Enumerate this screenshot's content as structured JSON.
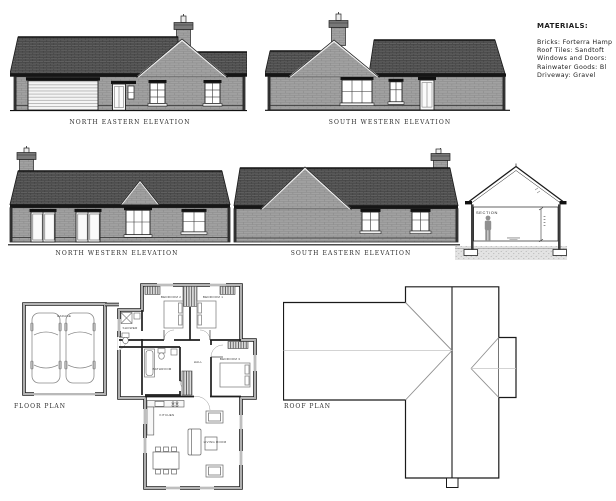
{
  "sheet": {
    "background": "#ffffff",
    "ink": "#1a1a1a",
    "roof_color": "#636363",
    "brick_color": "#a2a2a2",
    "ground_color": "#e3e3e3"
  },
  "captions": {
    "north_eastern": "NORTH EASTERN ELEVATION",
    "south_western": "SOUTH WESTERN ELEVATION",
    "north_western": "NORTH WESTERN ELEVATION",
    "south_eastern": "SOUTH EASTERN ELEVATION",
    "floor_plan": "FLOOR PLAN",
    "roof_plan": "ROOF PLAN",
    "section": "SECTION"
  },
  "materials": {
    "title": "MATERIALS:",
    "lines": [
      "Bricks: Forterra Hamp",
      "Roof Tiles: Sandtoft",
      "Windows and Doors:",
      "Rainwater Goods: Bl",
      "Driveway: Gravel"
    ]
  },
  "rooms": {
    "garage": "GARAGE",
    "bedroom1": "BEDROOM 1",
    "bedroom2": "BEDROOM 2",
    "bedroom3": "BEDROOM 3",
    "shower": "SHOWER",
    "bathroom": "BATHROOM",
    "hall": "HALL",
    "kitchen": "KITCHEN",
    "living": "LIVING ROOM"
  }
}
